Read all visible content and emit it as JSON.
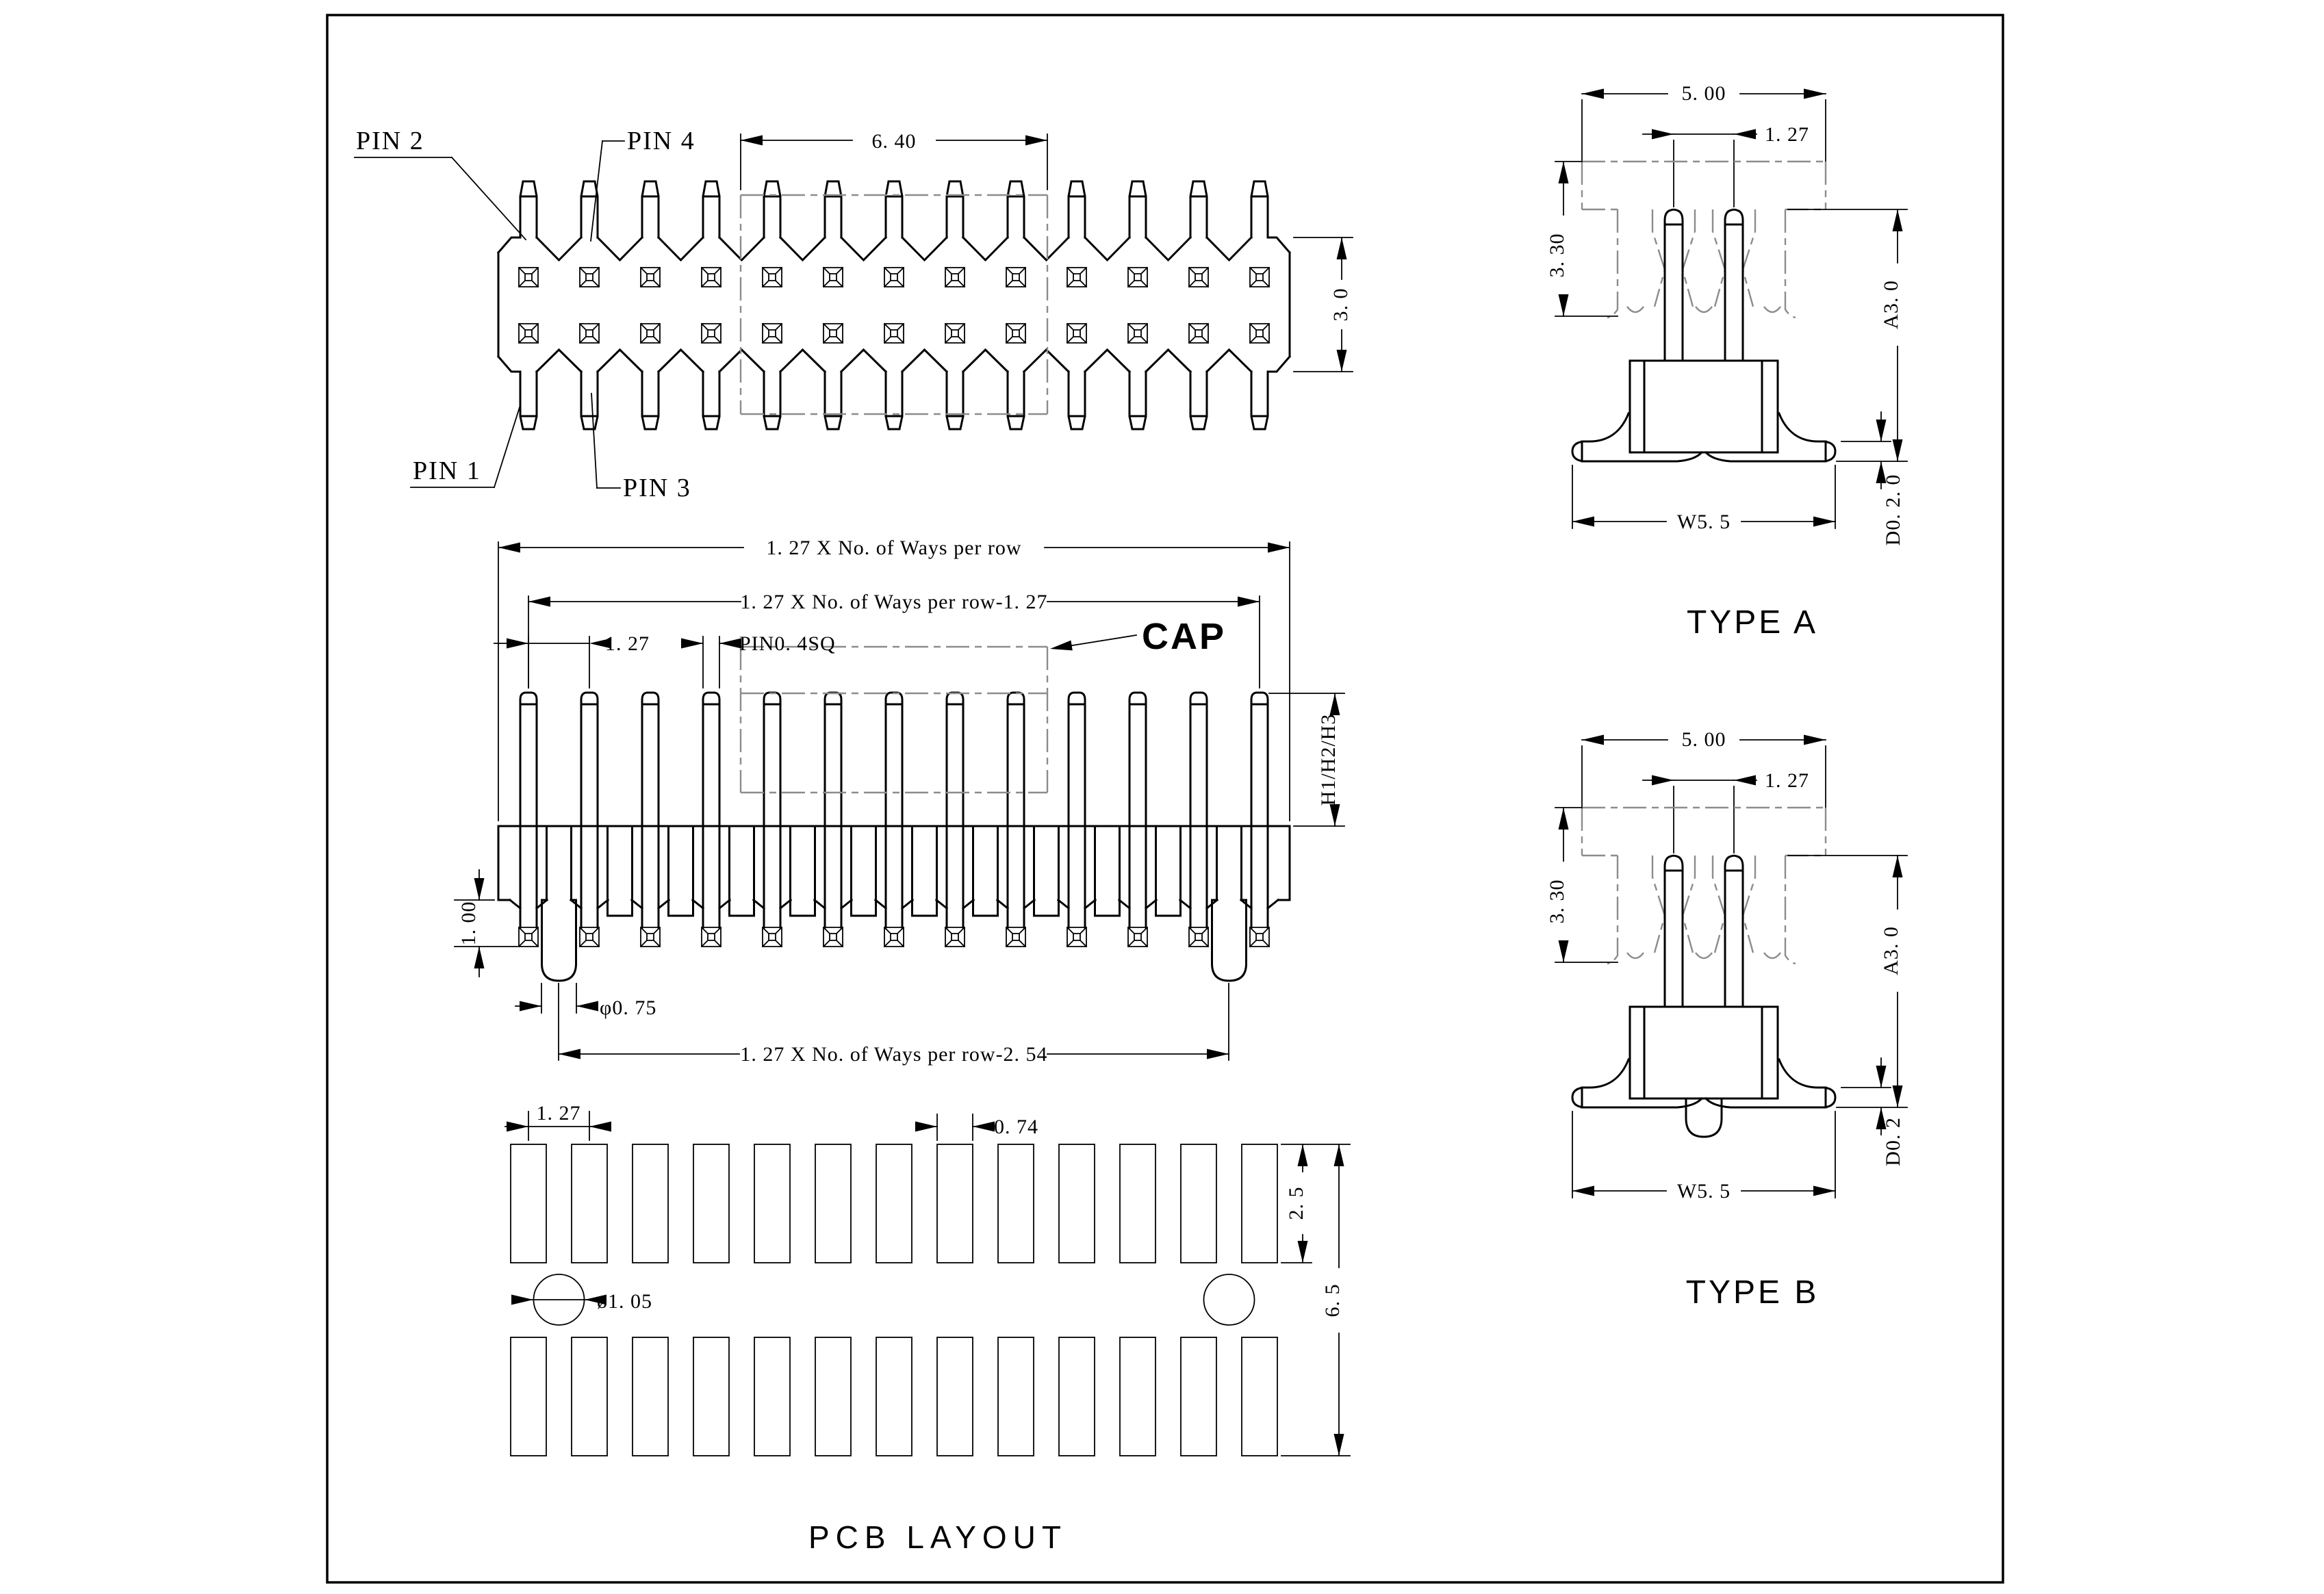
{
  "drawing": {
    "pins_per_row": 13,
    "rows": 2,
    "pads_per_row": 13,
    "line_color": "#000000",
    "phantom_color": "#8c8c8c"
  },
  "top_view": {
    "pin1": "PIN 1",
    "pin2": "PIN 2",
    "pin3": "PIN 3",
    "pin4": "PIN 4",
    "dim_cap_width": "6. 40",
    "dim_body_height": "3. 0"
  },
  "front_view": {
    "dim_total_width": "1. 27 X No. of Ways per row",
    "dim_pin_span": "1. 27 X No. of Ways per row-1. 27",
    "dim_pitch": "1. 27",
    "dim_pin_sq": "PIN0. 4SQ",
    "cap_label": "CAP",
    "dim_height": "H1/H2/H3",
    "dim_peg_protrusion": "1. 00",
    "dim_peg_dia": "φ0. 75",
    "dim_peg_span": "1. 27 X No. of Ways per row-2. 54"
  },
  "pcb_layout": {
    "dim_pitch": "1. 27",
    "dim_pad_width": "0. 74",
    "dim_hole_dia": "ø1. 05",
    "dim_pad_height": "2. 5",
    "dim_row_span": "6. 5",
    "title": "PCB LAYOUT"
  },
  "type_a": {
    "dim_width": "5. 00",
    "dim_pitch": "1. 27",
    "dim_cap_height": "3. 30",
    "dim_a": "A3. 0",
    "dim_d": "D0. 2. 0",
    "dim_w": "W5. 5",
    "label": "TYPE A"
  },
  "type_b": {
    "dim_width": "5. 00",
    "dim_pitch": "1. 27",
    "dim_cap_height": "3. 30",
    "dim_a": "A3. 0",
    "dim_d": "D0. 2",
    "dim_w": "W5. 5",
    "label": "TYPE B"
  }
}
